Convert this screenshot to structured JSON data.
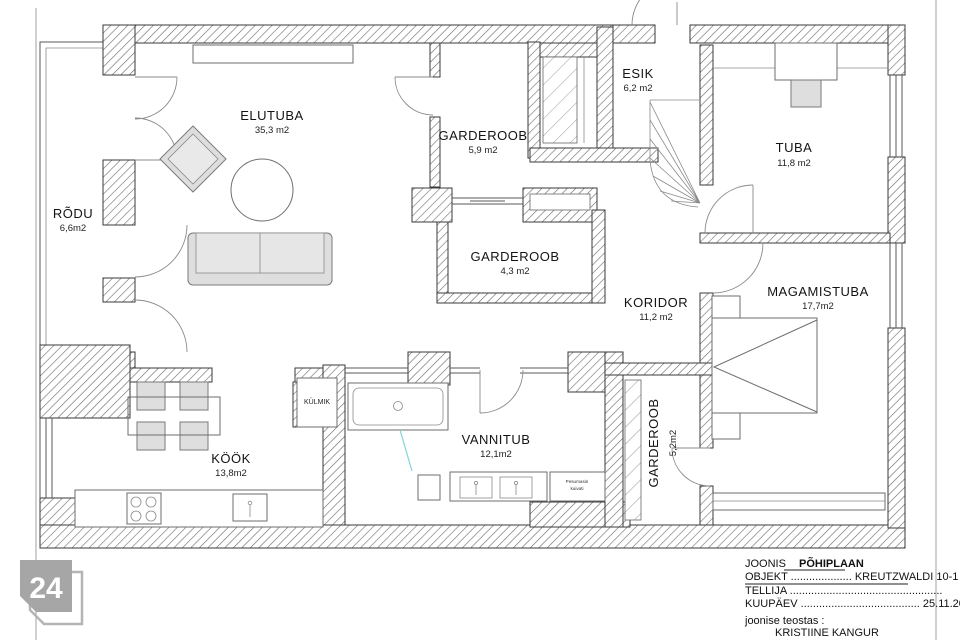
{
  "rooms": [
    {
      "name": "ELUTUBA",
      "area": "35,3 m2"
    },
    {
      "name": "RÕDU",
      "area": "6,6m2"
    },
    {
      "name": "GARDEROOB",
      "area": "5,9 m2"
    },
    {
      "name": "ESIK",
      "area": "6,2 m2"
    },
    {
      "name": "TUBA",
      "area": "11,8 m2"
    },
    {
      "name": "GARDEROOB",
      "area": "4,3 m2"
    },
    {
      "name": "KORIDOR",
      "area": "11,2 m2"
    },
    {
      "name": "MAGAMISTUBA",
      "area": "17,7m2"
    },
    {
      "name": "KÖÖK",
      "area": "13,8m2"
    },
    {
      "name": "VANNITUB",
      "area": "12,1m2"
    },
    {
      "name": "GARDEROOB",
      "area": "5,2m2"
    }
  ],
  "fixtures": {
    "fridge": "KÜLMIK",
    "washer_line1": "Pesumasin",
    "washer_line2": "kuivati"
  },
  "title_block": {
    "joonis_label": "JOONIS",
    "joonis_value": "PÕHIPLAAN",
    "objekt_label": "OBJEKT",
    "objekt_dots": "....................",
    "objekt_value": "KREUTZWALDI 10-1",
    "tellija_label": "TELLIJA",
    "tellija_dots": "..................................................",
    "kuupaev_label": "KUUPÄEV",
    "kuupaev_dots": ".......................................",
    "kuupaev_value": "25.11.2024",
    "credit_intro": "joonise teostas :",
    "credit_name": "KRISTIINE KANGUR",
    "credit_contact": "kristiine@liinginterior.ee, tel:+372 5221142"
  },
  "watermark": {
    "text": "24"
  },
  "colors": {
    "wall_line": "#3a3a3a",
    "watermark_gray": "#a6a6a6",
    "shower_glass": "#7fd4d8"
  }
}
